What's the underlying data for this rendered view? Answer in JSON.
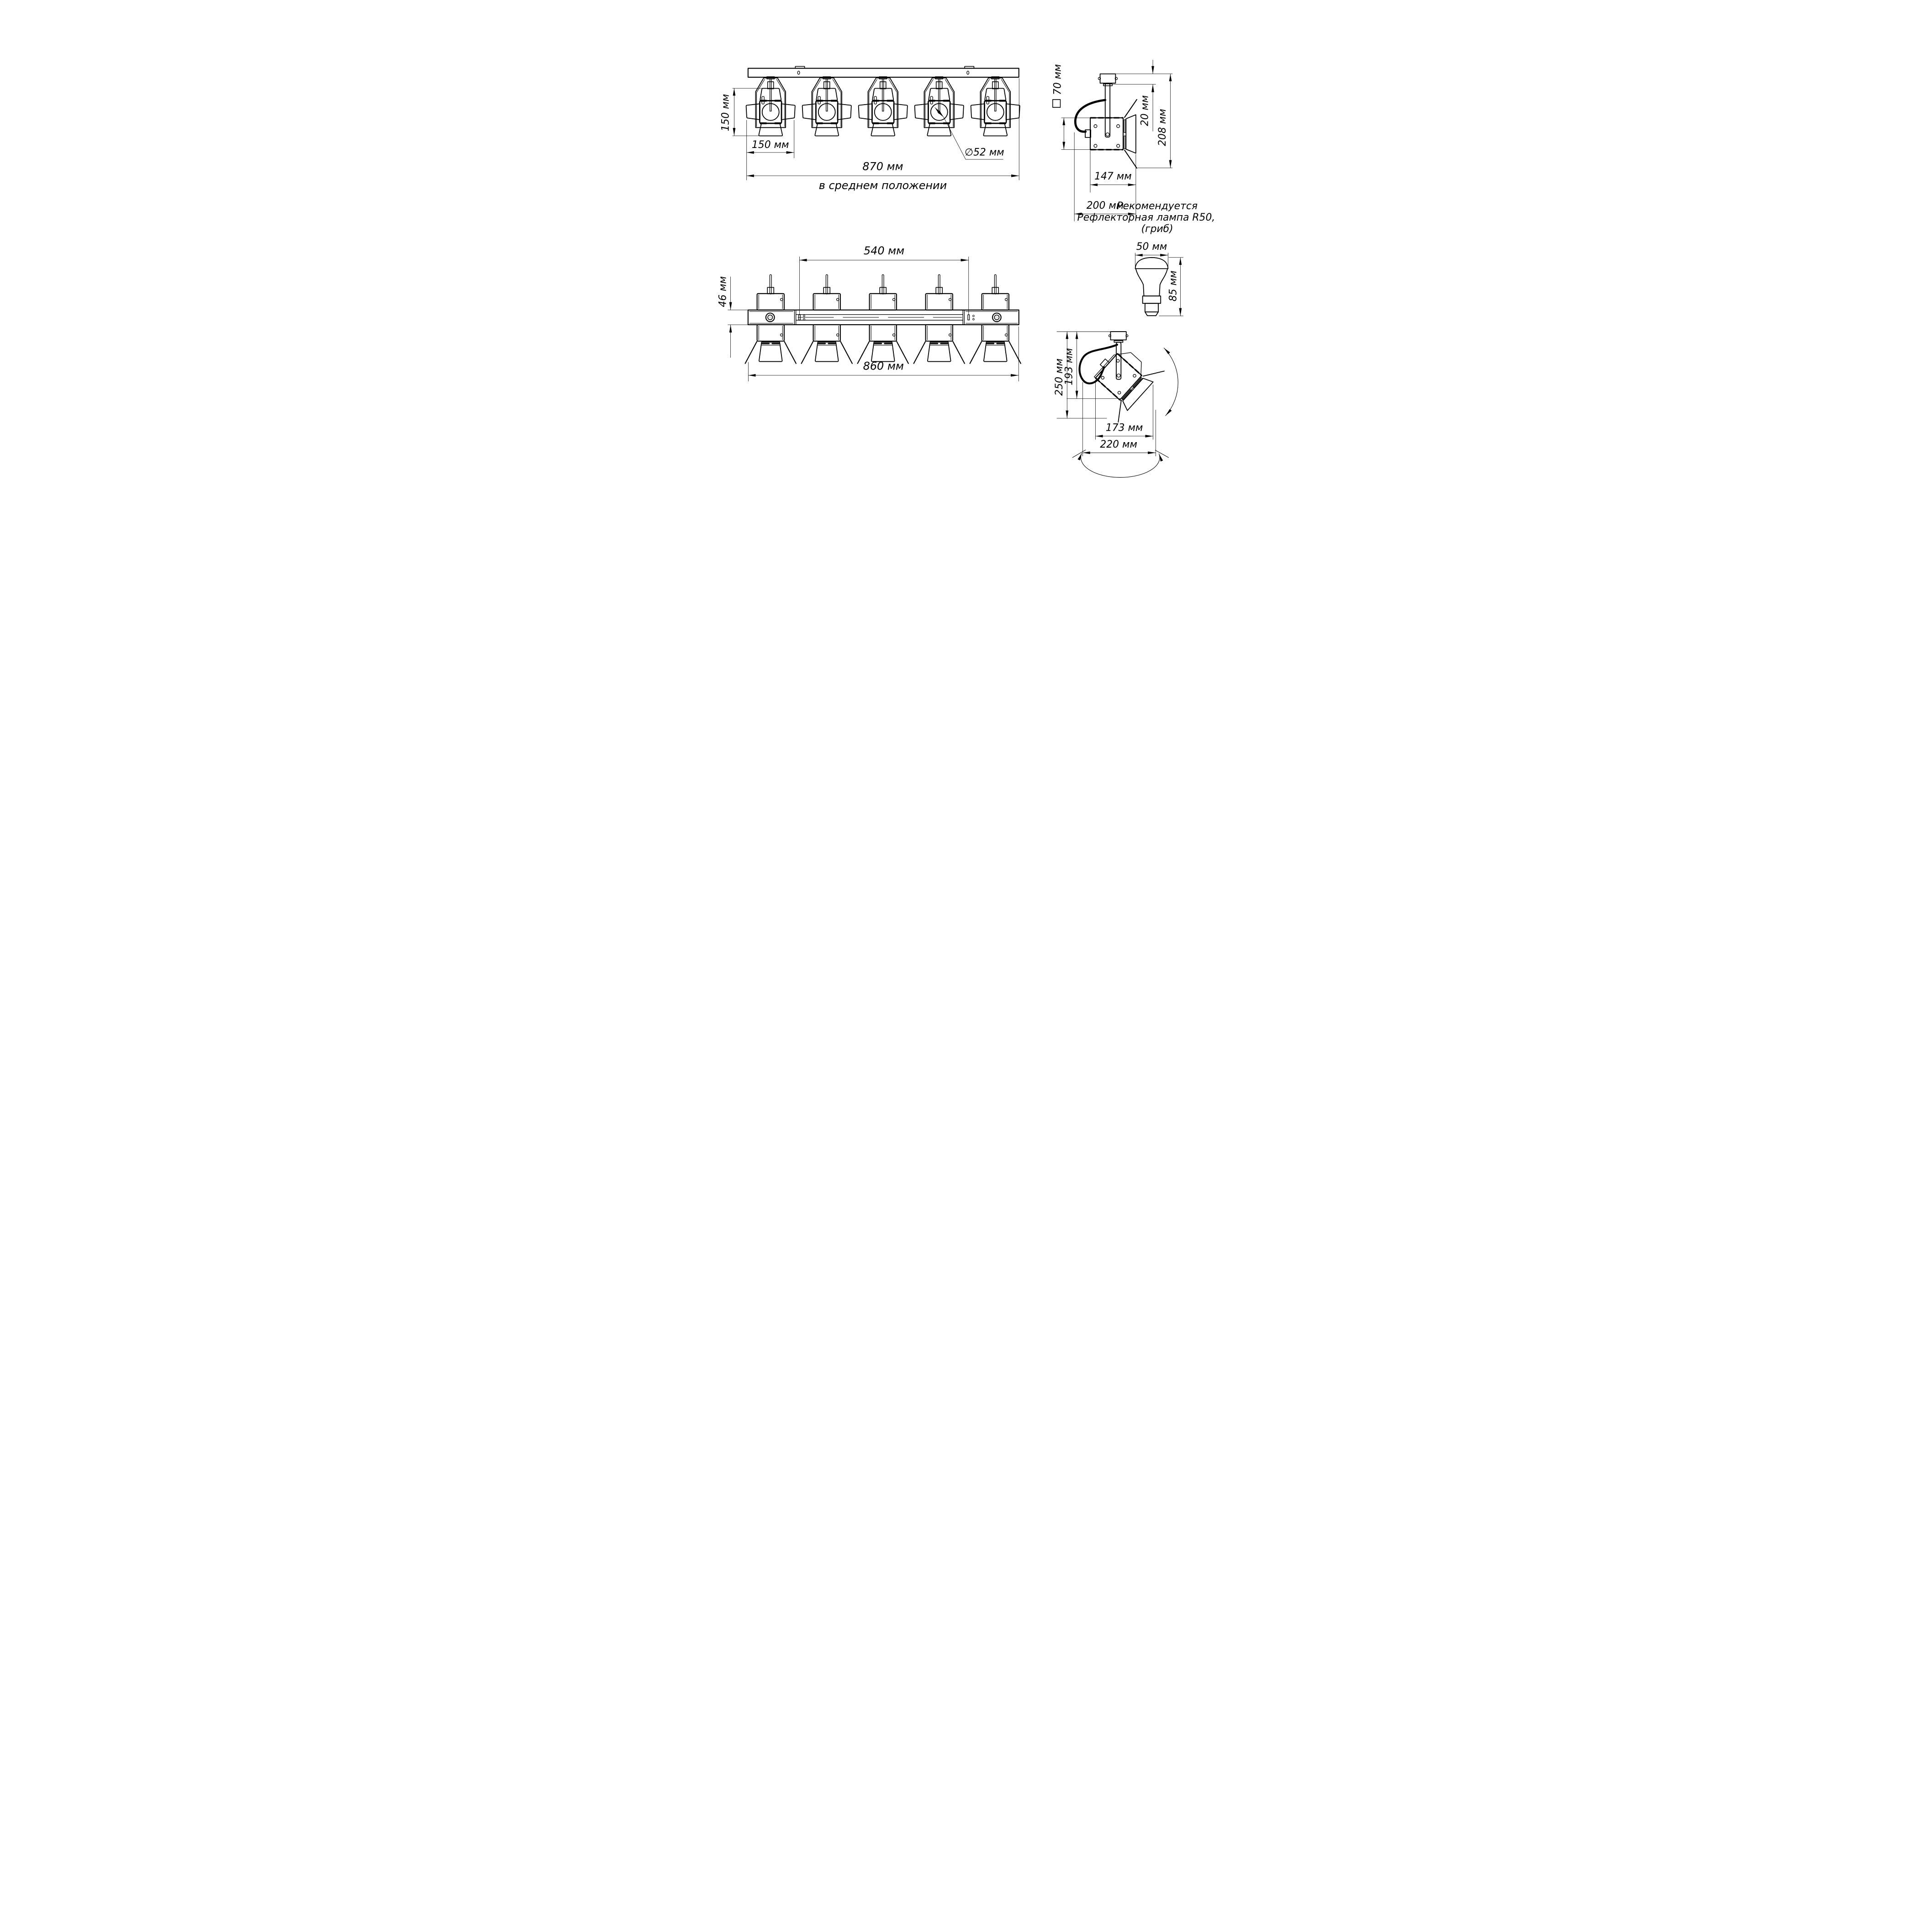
{
  "drawing": {
    "front_view": {
      "height_label": "150 мм",
      "flap_width_label": "150 мм",
      "overall_width_label": "870 мм",
      "position_note": "в среднем положении",
      "lens_diameter_label": "∅52 мм"
    },
    "side_view": {
      "body_square_label": "70 мм",
      "mount_height_label": "20 мм",
      "overall_height_label": "208 мм",
      "body_depth_label": "147 мм",
      "overall_depth_label": "200 мм"
    },
    "plan_view": {
      "track_length_label": "540 мм",
      "rail_height_label": "46 мм",
      "overall_length_label": "860 мм"
    },
    "bulb": {
      "recommend_line1": "Рекомендуется",
      "recommend_line2": "Рефлекторная лампа R50, Е14",
      "recommend_line3": "(гриб)",
      "diameter_label": "50 мм",
      "height_label": "85 мм"
    },
    "tilt_view": {
      "overall_height_label": "250 мм",
      "body_height_label": "193 мм",
      "body_width_label": "173 мм",
      "overall_width_label": "220 мм"
    }
  }
}
